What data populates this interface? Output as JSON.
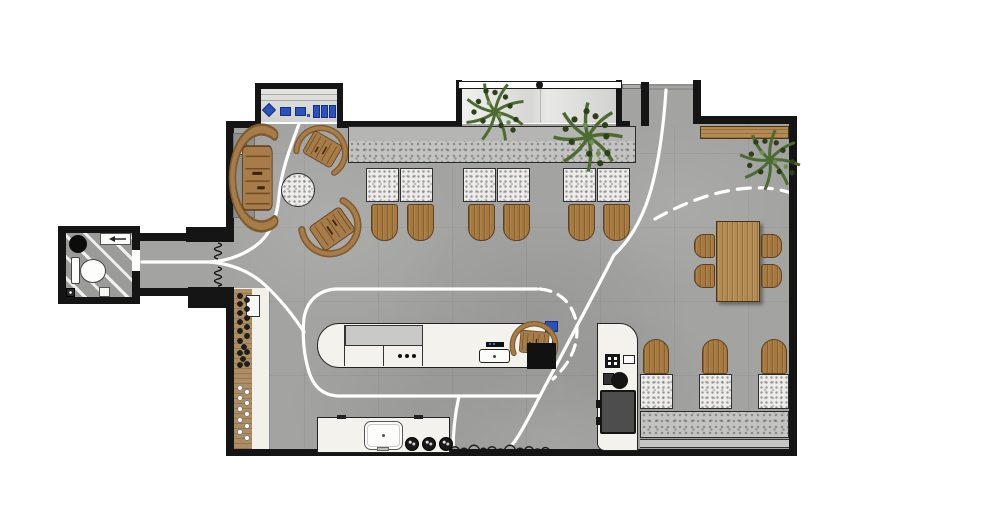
{
  "meta": {
    "description": "Top-down rendered architectural floor plan of a cafe / coffee bar",
    "canvas_width": 1000,
    "canvas_height": 530,
    "visible_text": "none"
  },
  "colors": {
    "background": "#ffffff",
    "wall": "#151515",
    "floor": "#a3a3a1",
    "bath-floor": "#9b9b99",
    "cream": "#f2f0e9",
    "counter": "#f4f2ec",
    "panel-gray": "#c9c9c7",
    "bench-back": "#b5b5b3",
    "bench-seat": "#c3c3c1",
    "terrazzo": "#edecea",
    "wood": "#a5793f",
    "wood-light": "#b28a52",
    "wood-shelf": "#ac8d64",
    "blue": "#2a52be",
    "machine": "#4d4d4d",
    "green": "#4c6a32",
    "green-dark": "#2e4019",
    "path": "#ffffff"
  },
  "rooms": [
    {
      "id": "restroom",
      "features": [
        "toilet",
        "round-basin",
        "towel-dispenser",
        "floor-drain",
        "diagonal-striped-floor"
      ]
    },
    {
      "id": "entry-vestibule",
      "features": [
        "coil-door-symbols",
        "circulation-path"
      ]
    },
    {
      "id": "main-hall",
      "features": [
        "retail-niche",
        "window-planter-bay",
        "entry-door-track",
        "circulation-paths"
      ]
    }
  ],
  "furniture": {
    "lounge": {
      "curved_wood_chairs": 3,
      "round_terrazzo_table": 1,
      "gray_side_panel": 1,
      "small_white_box": 1
    },
    "north_banquette": {
      "bench": 1,
      "terrazzo_tables": 6,
      "wood_chairs": 6
    },
    "window_bay_plants": 2,
    "corner_plant": 1,
    "north_wall_wood_bench": 1,
    "dining": {
      "wood_table": 1,
      "wood_chairs": 4
    },
    "east_banquette": {
      "bench": 1,
      "terrazzo_tables": 3,
      "wood_chairs": 3
    },
    "service_bar": {
      "counter": 1,
      "gray_prep_panel": 1,
      "faucet_dots": 3,
      "pos_register": 1,
      "host_chair": 1,
      "black_side_table": 1,
      "blue_case": 1
    },
    "barista_station": {
      "counter": 1,
      "espresso_machine": 1,
      "grinder": 1,
      "knock_box": 1,
      "small_white_box": 1
    },
    "back_counter": {
      "sink": 1,
      "dark_stools": 3,
      "edge_ticks": 2
    },
    "shelf": {
      "dark_bottles": 17,
      "light_bottles": 10,
      "appliance": 1
    },
    "retail_niche_items": {
      "blue_diamond": 1,
      "blue_squares": 2,
      "blue_boxes": 3,
      "blue_dot": 1
    }
  },
  "annotations": {
    "circulation": "white guest flow lines, solid and dashed arcs",
    "hedge": "scalloped shrub line along south wall",
    "door_symbols": "two vertical coil squiggles at vestibule opening"
  }
}
